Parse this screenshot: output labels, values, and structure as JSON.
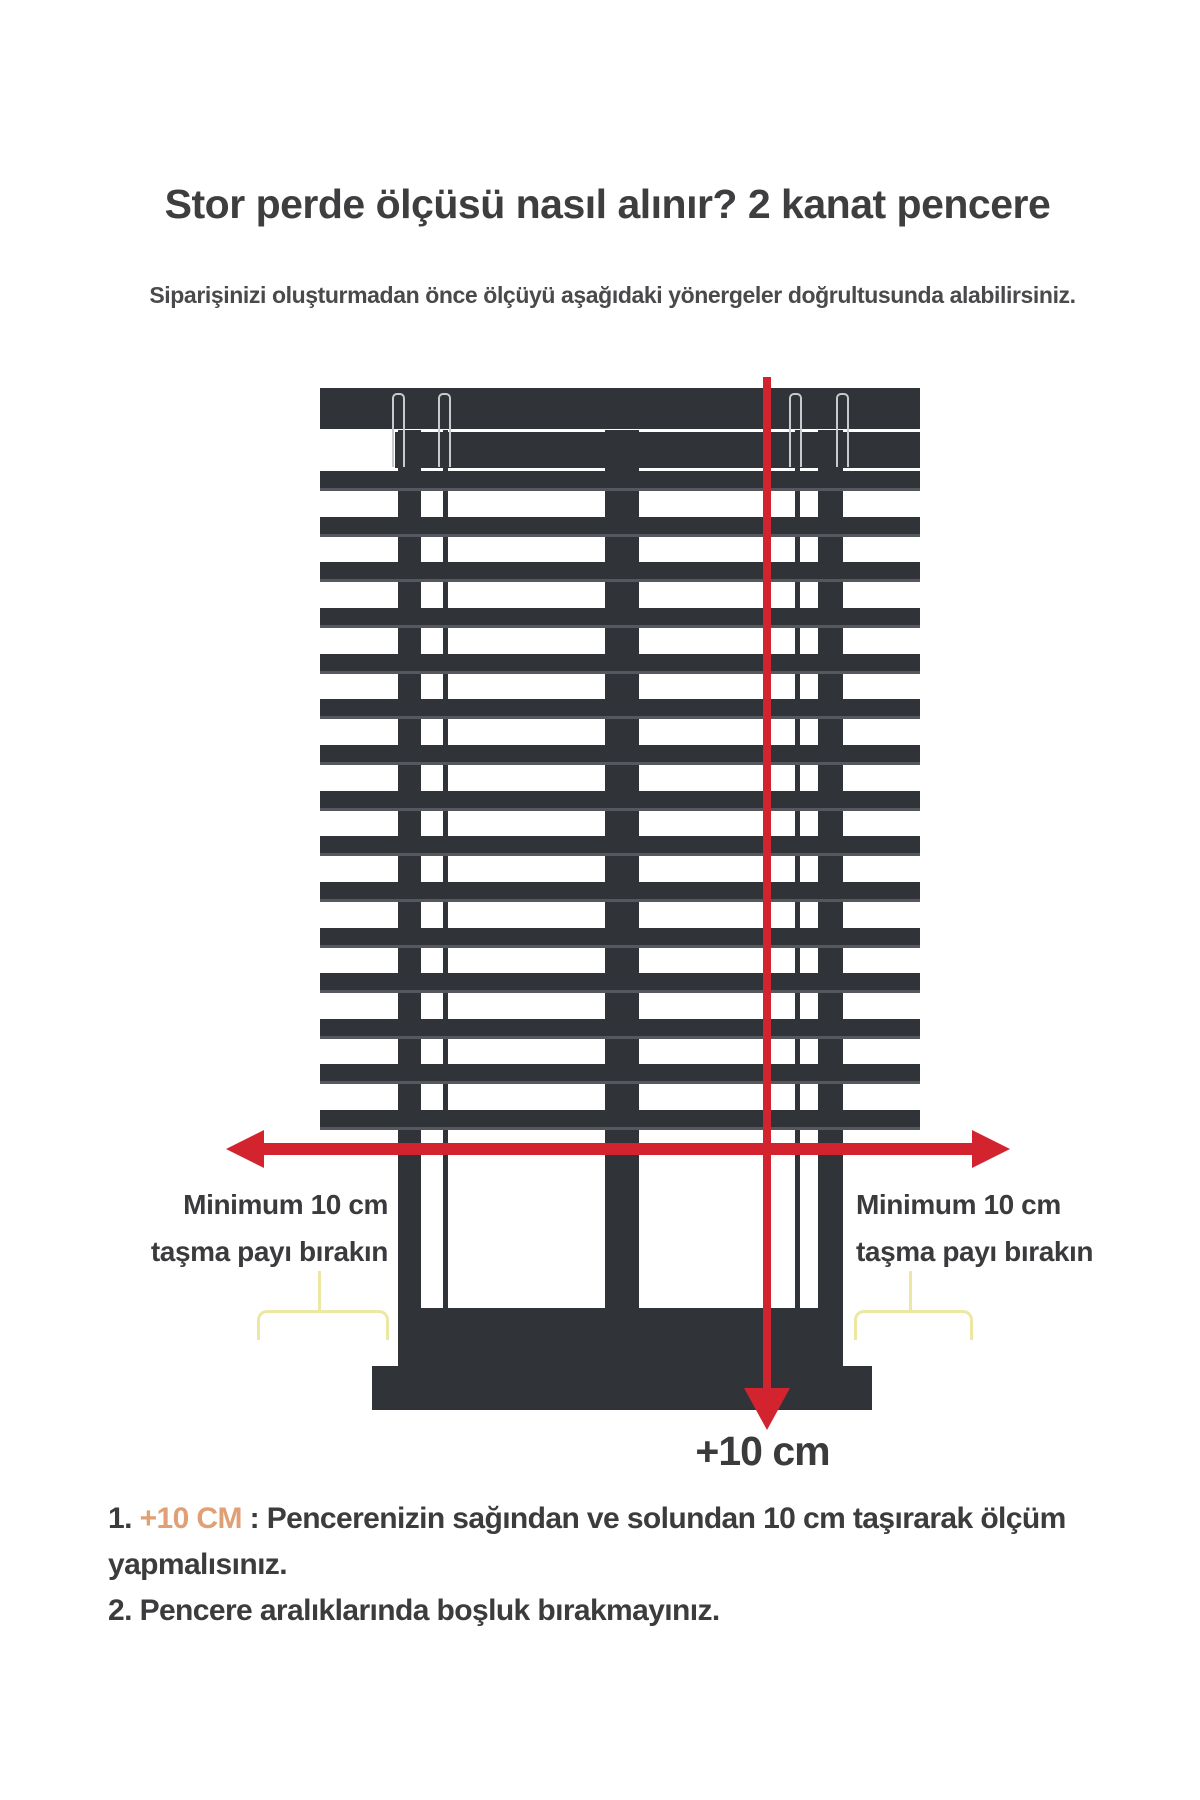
{
  "header": {
    "title": "Stor perde ölçüsü nasıl alınır? 2 kanat pencere",
    "subtitle": "Siparişinizi oluşturmadan önce ölçüyü aşağıdaki yönergeler doğrultusunda alabilirsiniz."
  },
  "diagram": {
    "slat_count": 15,
    "left_overhang_label": {
      "line1": "Minimum 10 cm",
      "line2": "taşma payı bırakın"
    },
    "right_overhang_label": {
      "line1": "Minimum 10 cm",
      "line2": "taşma payı bırakın"
    },
    "bottom_arrow_label": "+10 cm"
  },
  "footnotes": {
    "item1": {
      "prefix": "1. ",
      "highlight": "+10 CM",
      "text": " : Pencerenizin sağından ve solundan 10 cm taşırarak ölçüm yapmalısınız."
    },
    "item2": {
      "prefix": "2. ",
      "text": "Pencere aralıklarında boşluk bırakmayınız."
    }
  },
  "colors": {
    "frame-dark": "#303338",
    "frame-light": "#55585e",
    "accent-red": "#d2232e",
    "brace-yellow": "#ece7a2",
    "highlight-orange": "#dfa076",
    "text-dark": "#3c3b3d"
  }
}
